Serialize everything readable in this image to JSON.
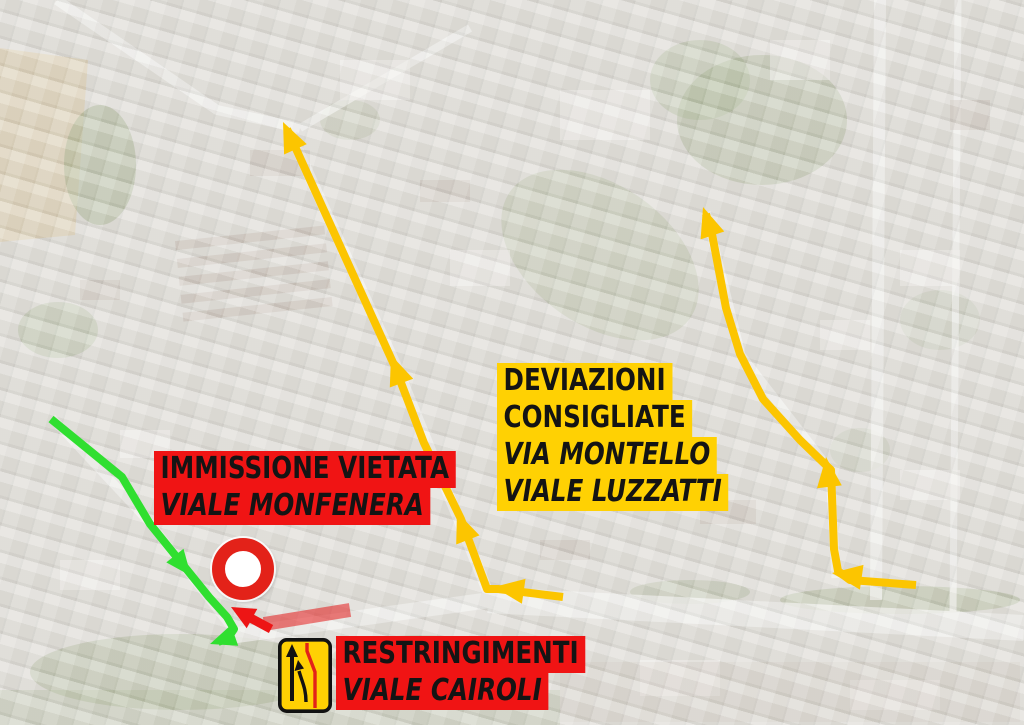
{
  "page": {
    "name": "traffic-detour-aerial-map"
  },
  "annotations": {
    "no_entry_label": {
      "line1": "IMMISSIONE VIETATA",
      "line2": "VIALE MONFENERA"
    },
    "detour_label": {
      "line1": "DEVIAZIONI",
      "line2": "CONSIGLIATE",
      "line3": "VIA MONTELLO",
      "line4": "VIALE LUZZATTI"
    },
    "narrowing_label": {
      "line1": "RESTRINGIMENTI",
      "line2": "VIALE CAIROLI"
    }
  },
  "icons": {
    "no_entry_sign": "road-closed-sign",
    "narrowing_sign": "road-narrowing-sign"
  },
  "colors": {
    "label_red": "#f01414",
    "label_yellow": "#ffd103",
    "label_text": "#141414",
    "route_yellow": "#fcc500",
    "route_green": "#30df30",
    "arrow_red": "#ed1515",
    "bar_red": "#e41a1a",
    "sign_red": "#e32219",
    "sign_yellow": "#ffd103",
    "map_base": "#dad8d3"
  },
  "routes": [
    {
      "name": "narrowing-zone-bar",
      "color": "#e41a1a",
      "width": 14,
      "opacity": 0.55,
      "points": [
        [
          264,
          624
        ],
        [
          350,
          610
        ]
      ],
      "arrows": []
    },
    {
      "name": "no-entry-direction-arrow",
      "color": "#ed1515",
      "width": 9,
      "arrow_length": 24,
      "arrow_width": 22,
      "points": [
        [
          271,
          629
        ],
        [
          243,
          614
        ]
      ],
      "arrows": [
        {
          "tip": [
            231,
            607
          ],
          "from": [
            271,
            629
          ]
        }
      ]
    },
    {
      "name": "detour-route-west",
      "color": "#fcc500",
      "width": 8,
      "arrow_length": 30,
      "arrow_width": 25,
      "points": [
        [
          563,
          597
        ],
        [
          498,
          589
        ],
        [
          487,
          589
        ],
        [
          461,
          519
        ],
        [
          424,
          443
        ],
        [
          395,
          367
        ],
        [
          287,
          129
        ]
      ],
      "arrows": [
        {
          "tip": [
            494,
            587
          ],
          "from": [
            563,
            597
          ]
        },
        {
          "tip": [
            457,
            512
          ],
          "from": [
            487,
            589
          ]
        },
        {
          "tip": [
            391,
            355
          ],
          "from": [
            424,
            443
          ]
        },
        {
          "tip": [
            283,
            122
          ],
          "from": [
            395,
            367
          ]
        }
      ]
    },
    {
      "name": "detour-route-east",
      "color": "#fcc500",
      "width": 8,
      "arrow_length": 30,
      "arrow_width": 25,
      "points": [
        [
          916,
          585
        ],
        [
          850,
          580
        ],
        [
          838,
          571
        ],
        [
          834,
          549
        ],
        [
          831,
          470
        ],
        [
          800,
          440
        ],
        [
          763,
          399
        ],
        [
          740,
          354
        ],
        [
          726,
          308
        ],
        [
          712,
          234
        ],
        [
          706,
          214
        ]
      ],
      "arrows": [
        {
          "tip": [
            832,
            573
          ],
          "from": [
            916,
            585
          ]
        },
        {
          "tip": [
            826,
            457
          ],
          "from": [
            832,
            510
          ]
        },
        {
          "tip": [
            703,
            207
          ],
          "from": [
            714,
            240
          ]
        }
      ]
    },
    {
      "name": "local-route-green",
      "color": "#30df30",
      "width": 8,
      "arrow_length": 26,
      "arrow_width": 22,
      "points": [
        [
          51,
          419
        ],
        [
          122,
          477
        ],
        [
          150,
          524
        ],
        [
          209,
          597
        ],
        [
          227,
          617
        ],
        [
          234,
          629
        ],
        [
          228,
          638
        ],
        [
          218,
          642
        ]
      ],
      "arrows": [
        {
          "tip": [
            191,
            576
          ],
          "from": [
            150,
            524
          ]
        },
        {
          "tip": [
            210,
            644
          ],
          "from": [
            230,
            637
          ]
        }
      ]
    }
  ]
}
